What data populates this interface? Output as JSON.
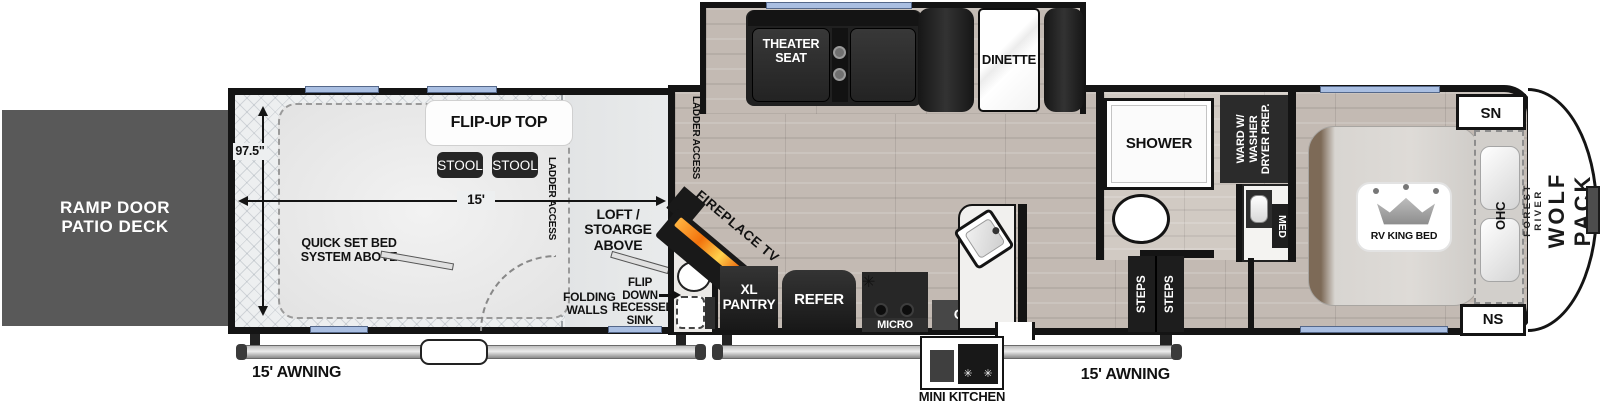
{
  "exterior": {
    "ramp_door": "RAMP DOOR\nPATIO DECK",
    "awning_left": "15' AWNING",
    "awning_right": "15' AWNING",
    "brand_top": "FOREST RIVER",
    "brand_bottom": "WOLF PACK"
  },
  "garage": {
    "height_dim": "97.5\"",
    "length_dim": "15'",
    "flip_up_top": "FLIP-UP TOP",
    "stool_left": "STOOL",
    "stool_right": "STOOL",
    "ladder_access_interior": "LADDER ACCESS",
    "ladder_access_wall": "LADDER ACCESS",
    "quick_set_bed": "QUICK SET BED\nSYSTEM ABOVE",
    "loft_storage": "LOFT / STOARGE\nABOVE",
    "folding_walls": "FOLDING\nWALLS",
    "flip_down_sink": "FLIP\nDOWN\nRECESSED\nSINK"
  },
  "slideout": {
    "theater_seat": "THEATER\nSEAT",
    "dinette": "DINETTE"
  },
  "kitchen": {
    "fireplace_tv": "FIREPLACE TV",
    "xl_pantry": "XL\nPANTRY",
    "refer": "REFER",
    "micro": "MICRO",
    "ohc": "OHC",
    "mini_kitchen": "MINI KITCHEN"
  },
  "bathroom": {
    "shower": "SHOWER",
    "wardrobe": "WARD W/\nWASHER\nDRYER PREP.",
    "med": "MED"
  },
  "bedroom": {
    "steps_1": "STEPS",
    "steps_2": "STEPS",
    "ns_top": "NS",
    "ns_bottom": "NS",
    "ohc": "OHC",
    "rv_king_bed": "RV KING BED"
  },
  "colors": {
    "wall": "#141414",
    "window_accent": "#aabfe2",
    "ramp_deck": "#595959",
    "flame": "#f2720c"
  }
}
